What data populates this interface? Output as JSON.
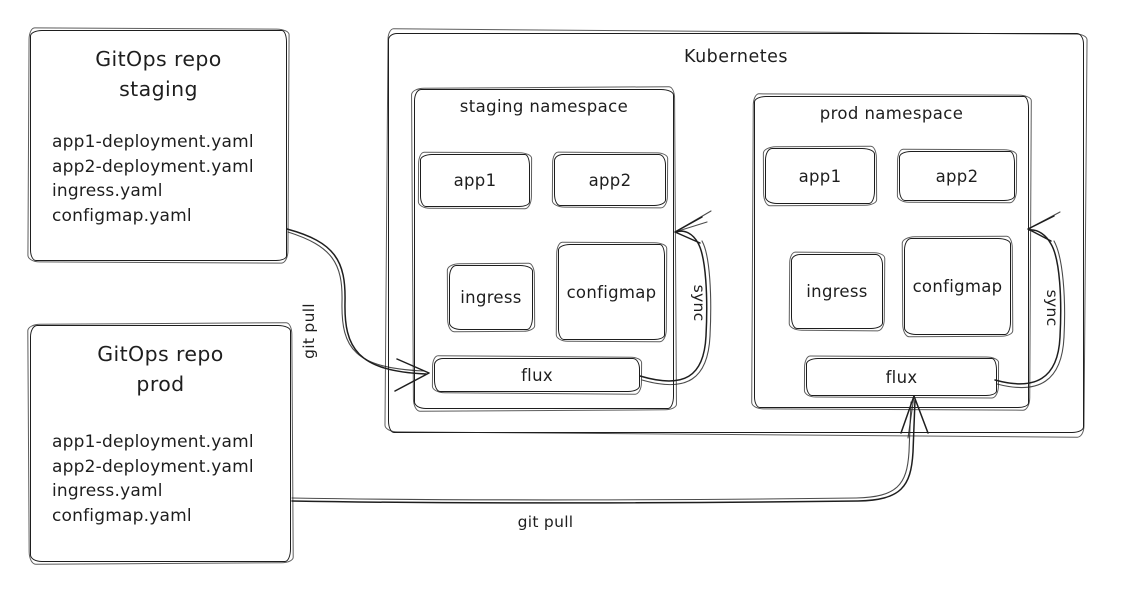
{
  "diagram": {
    "repos": [
      {
        "title_lines": [
          "GitOps repo",
          "staging"
        ],
        "files": [
          "app1-deployment.yaml",
          "app2-deployment.yaml",
          "ingress.yaml",
          "configmap.yaml"
        ]
      },
      {
        "title_lines": [
          "GitOps repo",
          "prod"
        ],
        "files": [
          "app1-deployment.yaml",
          "app2-deployment.yaml",
          "ingress.yaml",
          "configmap.yaml"
        ]
      }
    ],
    "kubernetes": {
      "label": "Kubernetes",
      "namespaces": [
        {
          "label": "staging namespace",
          "workloads": [
            "app1",
            "app2"
          ],
          "resources": [
            "ingress",
            "configmap"
          ],
          "controller": "flux"
        },
        {
          "label": "prod namespace",
          "workloads": [
            "app1",
            "app2"
          ],
          "resources": [
            "ingress",
            "configmap"
          ],
          "controller": "flux"
        }
      ]
    },
    "edges": {
      "staging_pull_label": "git pull",
      "prod_pull_label": "git pull",
      "staging_sync_label": "sync",
      "prod_sync_label": "sync"
    },
    "colors": {
      "ink": "#1e1e1e",
      "background": "#ffffff"
    }
  }
}
